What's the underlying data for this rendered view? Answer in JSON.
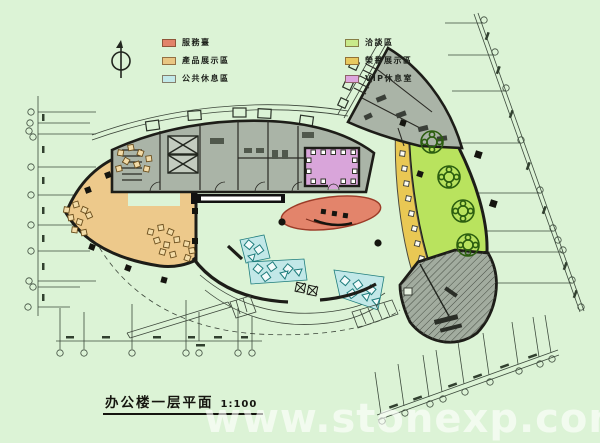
{
  "title": {
    "text": "办公楼一层平面",
    "scale": "1:100"
  },
  "watermark": {
    "text": "www.stonexp.com"
  },
  "legend": {
    "items": [
      {
        "id": "service-desk",
        "label": "服務臺",
        "color": "#e2836a"
      },
      {
        "id": "product-display",
        "label": "產品展示區",
        "color": "#e9c683"
      },
      {
        "id": "public-rest",
        "label": "公共休息區",
        "color": "#c2e9e9"
      },
      {
        "id": "negotiation",
        "label": "洽談區",
        "color": "#c9ea8a"
      },
      {
        "id": "honor-display",
        "label": "榮譽展示區",
        "color": "#e8c95f"
      },
      {
        "id": "vip-lounge",
        "label": "VIP休息室",
        "color": "#dda6de"
      }
    ]
  },
  "plan": {
    "zones": [
      {
        "id": "product-display",
        "label": "產品展示區"
      },
      {
        "id": "service-desk",
        "label": "服務臺"
      },
      {
        "id": "public-rest",
        "label": "公共休息區"
      },
      {
        "id": "negotiation",
        "label": "洽談區"
      },
      {
        "id": "honor-display",
        "label": "榮譽展示區"
      },
      {
        "id": "vip-lounge",
        "label": "VIP休息室"
      }
    ],
    "colors": {
      "bg": "#dcf3d6",
      "zone-product": "#edc98b",
      "zone-service": "#e3846b",
      "zone-rest": "#c2e8e8",
      "zone-negotiation": "#b9e35e",
      "zone-honor": "#e9c854",
      "zone-vip": "#d9a5da",
      "core-gray": "#aab4a7",
      "hatch-gray": "#a2ac9f",
      "wall": "#1d1d18",
      "dim": "#3c4a3c",
      "sofa-line": "#1f7d7d",
      "table-line": "#2c5e10"
    }
  }
}
